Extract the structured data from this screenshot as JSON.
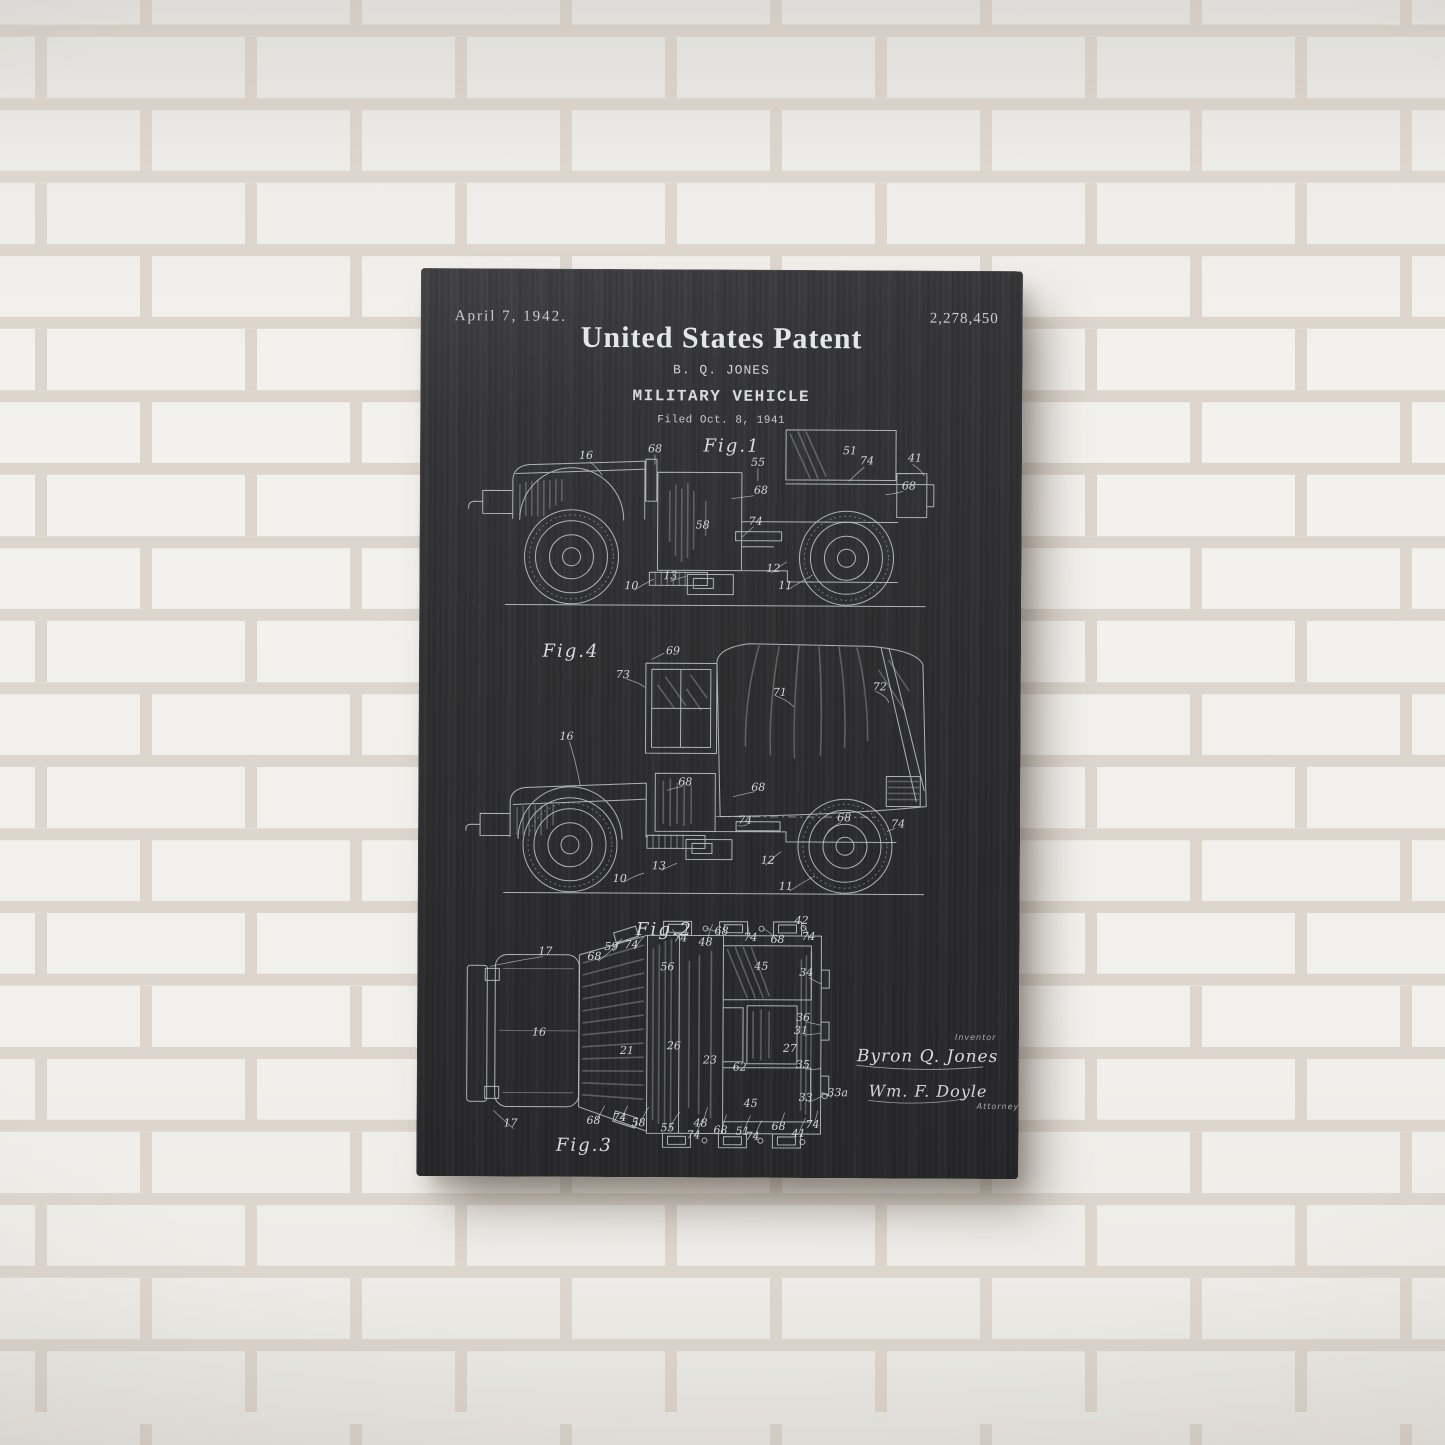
{
  "palette": {
    "wall": "#f2f0ec",
    "mortar": "#dcd6cd",
    "poster_background": "#2e2e30",
    "ink": "#d4d6d8"
  },
  "poster": {
    "header": {
      "date": "April 7, 1942.",
      "patent_number": "2,278,450",
      "title": "United States Patent",
      "inventor": "B. Q. JONES",
      "subject": "MILITARY VEHICLE",
      "filed": "Filed Oct. 8, 1941"
    },
    "figures": {
      "fig1": {
        "label": "Fig.1",
        "callouts": [
          "16",
          "68",
          "55",
          "51",
          "74",
          "41",
          "68",
          "68",
          "58",
          "74",
          "13",
          "10",
          "12",
          "11"
        ]
      },
      "fig4": {
        "label": "Fig.4",
        "callouts": [
          "69",
          "73",
          "71",
          "72",
          "16",
          "68",
          "68",
          "74",
          "68",
          "74",
          "12",
          "13",
          "10",
          "11"
        ]
      },
      "fig23": {
        "label_top": "Fig.2",
        "label_bottom": "Fig.3",
        "callouts": [
          "17",
          "68",
          "59",
          "74",
          "74",
          "48",
          "68",
          "74",
          "68",
          "42",
          "74",
          "56",
          "45",
          "34",
          "16",
          "21",
          "26",
          "23",
          "62",
          "27",
          "36",
          "31",
          "35",
          "33",
          "33a",
          "45",
          "17",
          "68",
          "74",
          "58",
          "55",
          "48",
          "74",
          "68",
          "51",
          "74",
          "68",
          "41",
          "74"
        ]
      }
    },
    "signatures": {
      "inventor_label": "Inventor",
      "inventor_name": "Byron Q. Jones",
      "attorney_name": "Wm. F. Doyle",
      "attorney_label": "Attorney"
    }
  }
}
